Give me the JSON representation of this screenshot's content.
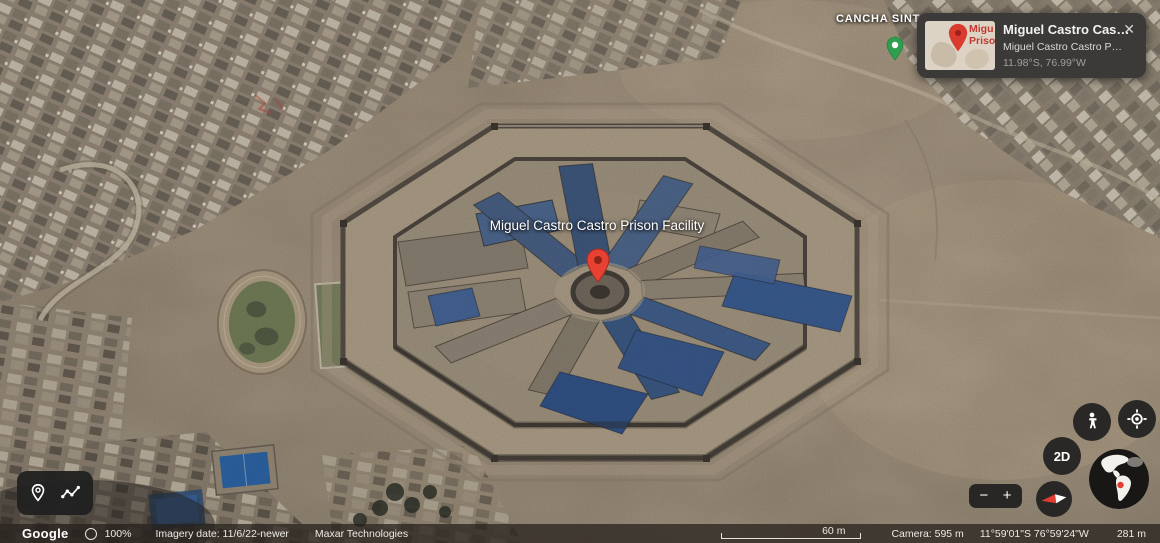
{
  "map": {
    "prison_label": "Miguel Castro Castro Prison Facility",
    "cancha_label": "CANCHA SINT"
  },
  "info_card": {
    "title": "Miguel Castro Cas…",
    "subtitle": "Miguel Castro Castro P…",
    "coordinates": "11.98°S, 76.99°W",
    "close": "✕",
    "thumb_line1": "Migu",
    "thumb_line2": "Priso"
  },
  "controls": {
    "mode_2d": "2D",
    "zoom_out": "−",
    "zoom_in": "+"
  },
  "status_bar": {
    "brand": "Google",
    "percent": "100%",
    "imagery": "Imagery date: 11/6/22-newer",
    "provider": "Maxar Technologies",
    "scale": "60 m",
    "camera": "Camera: 595 m",
    "coords": "11°59'01\"S 76°59'24\"W",
    "elevation": "281 m"
  },
  "colors": {
    "pin_red": "#e74133",
    "pin_green": "#2f9e4f",
    "roof_blue": "#3b5e94",
    "terrain": "#a89a85"
  }
}
